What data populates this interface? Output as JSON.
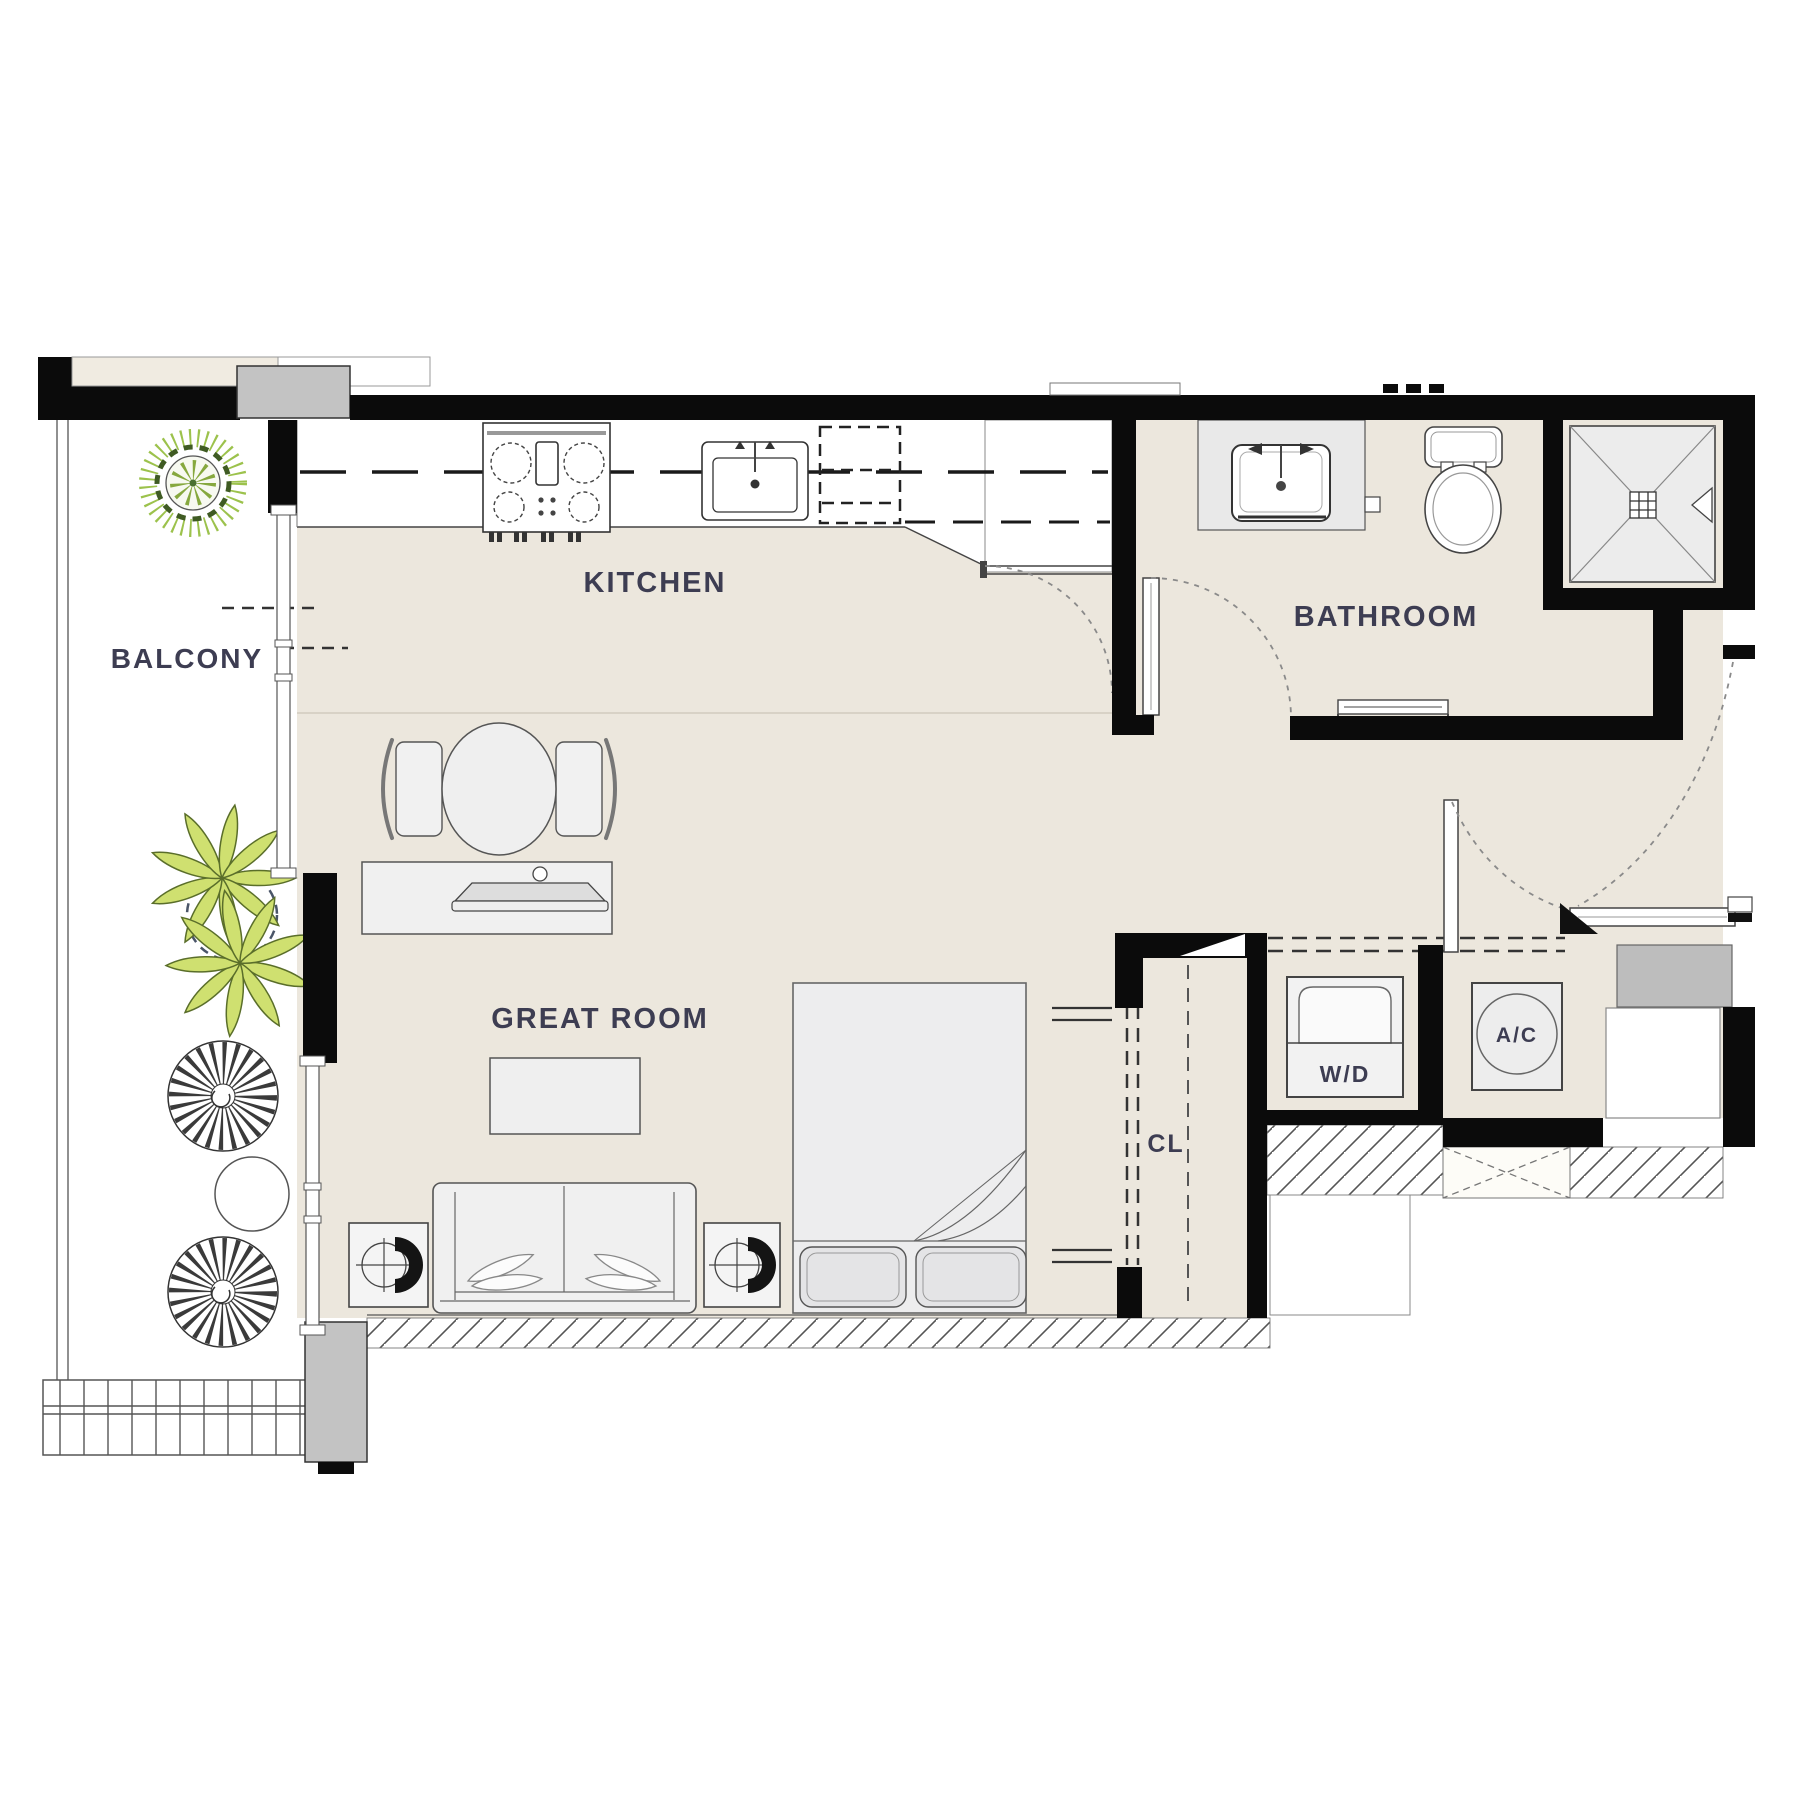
{
  "plan": {
    "rooms": [
      {
        "id": "balcony",
        "label": "BALCONY"
      },
      {
        "id": "kitchen",
        "label": "KITCHEN"
      },
      {
        "id": "bathroom",
        "label": "BATHROOM"
      },
      {
        "id": "great_room",
        "label": "GREAT ROOM"
      },
      {
        "id": "closet",
        "label": "CL"
      },
      {
        "id": "laundry",
        "label": "W/D"
      },
      {
        "id": "ac_closet",
        "label": "A/C"
      }
    ],
    "colors": {
      "wall": "#0b0b0b",
      "interior_floor": "#ece7dd",
      "balcony_floor": "#ffffff",
      "fixture_fill": "#efefef",
      "column_gray": "#c3c3c3",
      "plant_green": "#9cc24c",
      "label_text": "#3d3d52"
    },
    "fixtures": [
      "range-cooktop",
      "kitchen-sink",
      "refrigerator-dashed",
      "pantry-closet",
      "vanity-sink",
      "toilet",
      "shower",
      "towel-bar",
      "dining-table",
      "dining-chairs",
      "tv-console",
      "coffee-table",
      "sofa",
      "end-tables",
      "bed",
      "washer-dryer",
      "ac-unit",
      "sliding-closet-doors",
      "balcony-tree",
      "balcony-palm",
      "wicker-chairs",
      "balcony-side-table",
      "balcony-railing",
      "entry-door",
      "corridor-hatch"
    ]
  }
}
